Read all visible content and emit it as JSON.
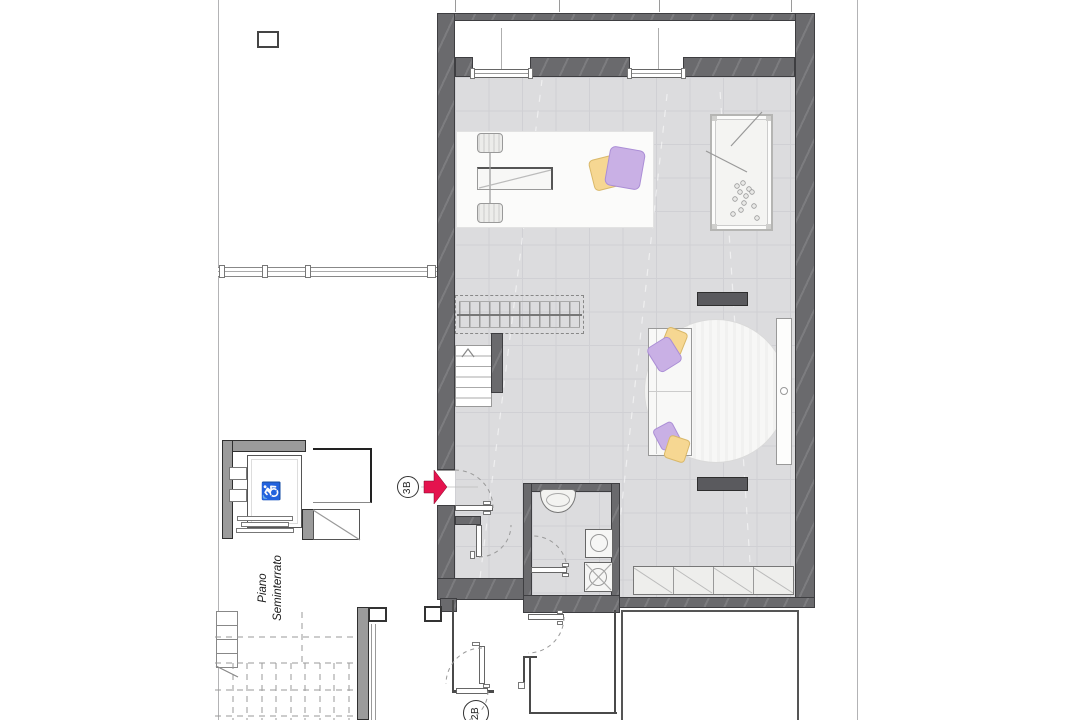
{
  "plan": {
    "floor_label": {
      "line1": "Piano",
      "line2": "Seminterrato"
    },
    "units": {
      "unit_3b": "3B",
      "unit_2b": "2B"
    },
    "elevator": {
      "wheelchair_symbol": "♿"
    }
  },
  "colors": {
    "wall_dark": "#6a6a6d",
    "wall_light": "#9b9b9b",
    "floor_tile": "#dcdcde",
    "accent_arrow_red": "#e5134e",
    "cushion_yellow": "#f6d792",
    "cushion_purple": "#c9b0e5",
    "radiator_dark": "#5a5a5e"
  }
}
